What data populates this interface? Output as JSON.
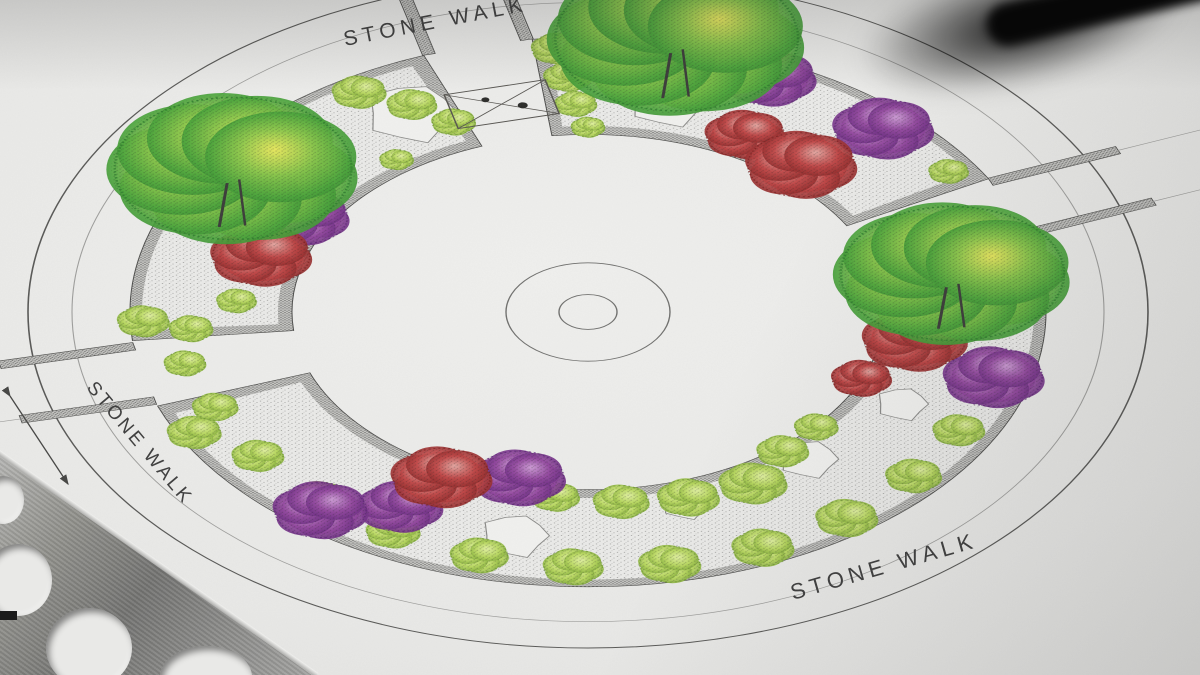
{
  "scene": {
    "labels": {
      "stone_walk_top": "STONE WALK",
      "stone_walk_left": "STONE WALK",
      "stone_walk_bottom": "STONE WALK"
    },
    "palette": {
      "paper": "#e9e9e7",
      "line_dark": "#4f4f4d",
      "line_mid": "#6f6f6d",
      "line_light": "#9d9d9b",
      "label_ink": "#3c3c3c",
      "edging": "#c5c5c2",
      "bed_ground": "#ebebe9",
      "stone_white": "#f1f1ef",
      "lime": "#b9d95f",
      "lime_hi": "#e4f2a6",
      "lime_dark": "#6f9c2d",
      "tree_green": "#49a439",
      "tree_hi": "#eeea5e",
      "tree_dark": "#2d7c2b",
      "purple": "#93479f",
      "purple_hi": "#d2a3da",
      "purple_dark": "#5e2378",
      "red": "#c04545",
      "red_hi": "#e7afa9",
      "red_dark": "#7e1f1f",
      "ruler_metal": "#8a8a88",
      "pen_black": "#070707"
    }
  }
}
